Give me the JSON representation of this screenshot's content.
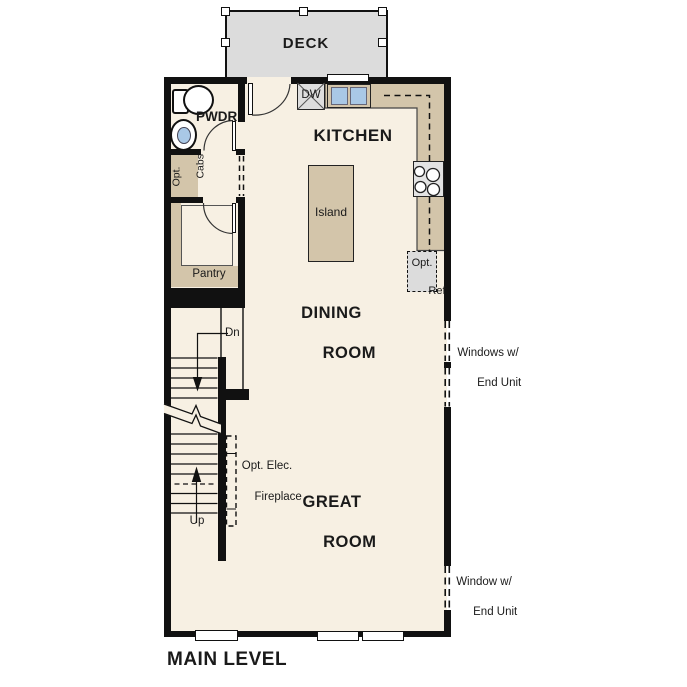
{
  "title": "MAIN LEVEL",
  "colors": {
    "wall": "#111111",
    "floor": "#f7f0e3",
    "counter_tan": "#d3c5aa",
    "deck_gray": "#dcdcdc",
    "appliance_gray": "#e0e0e0",
    "sink_blue": "#a9c8e6"
  },
  "rooms": {
    "deck": {
      "label": "DECK"
    },
    "powder": {
      "label": "PWDR"
    },
    "kitchen": {
      "label": "KITCHEN"
    },
    "dining": {
      "lines": [
        "DINING",
        "ROOM"
      ]
    },
    "great": {
      "lines": [
        "GREAT",
        "ROOM"
      ]
    },
    "pantry": {
      "label": "Pantry"
    }
  },
  "fixtures": {
    "island": {
      "label": "Island"
    },
    "dishwasher": {
      "label": "DW"
    },
    "opt_ref": {
      "lines": [
        "Opt.",
        "Ref"
      ]
    },
    "opt_cabs": {
      "lines": [
        "Opt.",
        "Cabs"
      ]
    }
  },
  "stairs": {
    "down": "Dn",
    "up": "Up"
  },
  "annotations": {
    "fireplace": {
      "lines": [
        "Opt. Elec.",
        "Fireplace"
      ]
    },
    "windows_upper": {
      "lines": [
        "Windows w/",
        "End Unit"
      ]
    },
    "window_lower": {
      "lines": [
        "Window w/",
        "End Unit"
      ]
    }
  }
}
